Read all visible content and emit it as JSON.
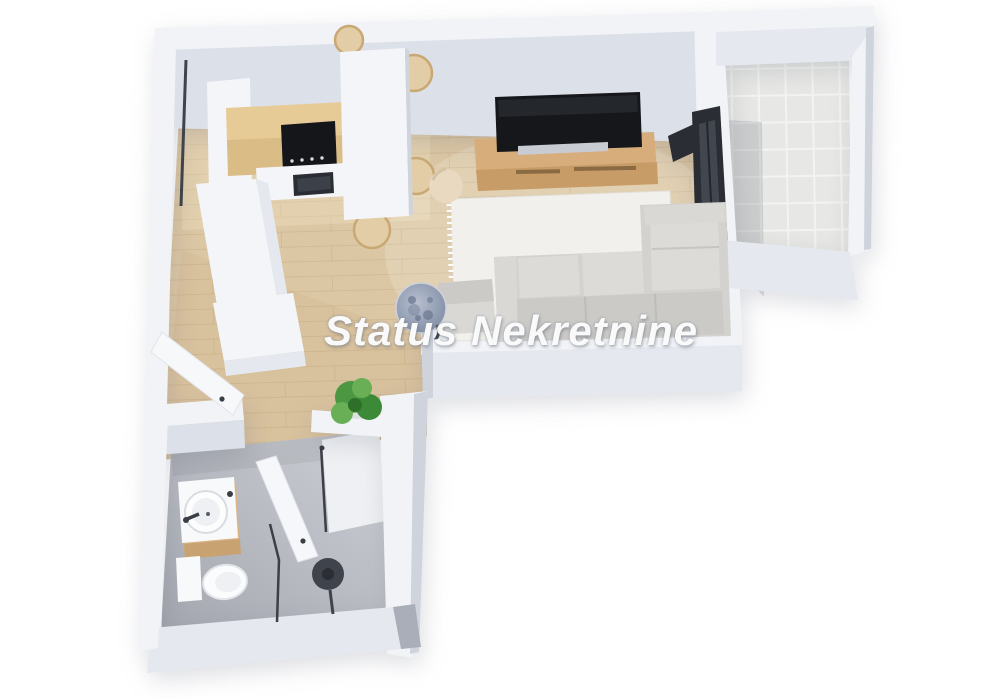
{
  "watermark": {
    "text": "Status Nekretnine"
  },
  "scene": {
    "kind": "apartment-3d-floor-plan-rendering",
    "rooms": [
      "kitchen",
      "dining-area",
      "living-room",
      "balcony",
      "hallway",
      "bathroom"
    ],
    "objects": [
      "kitchen-counter",
      "cooktop",
      "oven",
      "wood-backsplash",
      "kitchen-peninsula",
      "dining-table",
      "dining-chairs",
      "tv",
      "tv-console",
      "area-rug",
      "corner-sofa",
      "armchair",
      "round-marble-table",
      "pouf",
      "balcony-tile-floor",
      "sliding-glass-door",
      "window-slit",
      "entry-door",
      "wardrobe-bench",
      "potted-plant",
      "bathroom-door",
      "vanity-cabinet",
      "round-washbasin",
      "toilet",
      "shower-glass-partition",
      "rain-shower-head"
    ]
  },
  "colors": {
    "background": "#ffffff",
    "wall_top": "#f1f3f7",
    "wall_face": "#dce0e9",
    "wall_front": "#e5e8ef",
    "wall_side": "#cfd3dc",
    "wall_side_dark": "#a9aeb8",
    "floor_wood": "#dcc7a4",
    "floor_wood_line": "#c9af88",
    "floor_tile": "#e7e8e5",
    "tile_grout": "#f3f4f1",
    "counter": "#f4f5f8",
    "table_white": "#f4f5f8",
    "backsplash_wood": "#e7cb96",
    "stove": "#15161a",
    "oven": "#2a2d33",
    "chair_wood": "#e2cda6",
    "chair_wood_edge": "#c8a873",
    "console_wood": "#d6ad7b",
    "console_wood_front": "#c79c67",
    "tv": "#16171a",
    "rug": "#f1f0ec",
    "sofa": "#d3d2cf",
    "sofa_seat": "#dcdbd8",
    "sofa_back": "#cbcac7",
    "armchair": "#d9d8d5",
    "pouf": "#e8d9c0",
    "marble_table": "#8d99af",
    "glass_door": "#2a2d33",
    "glass_pane": "#474c55",
    "fixture": "#f8f9fb",
    "vanity_wood": "#d9b586",
    "metal_dark": "#3a3e45",
    "plant_dark": "#3c8a37",
    "plant_mid": "#4c9742",
    "plant_light": "#68af56"
  }
}
